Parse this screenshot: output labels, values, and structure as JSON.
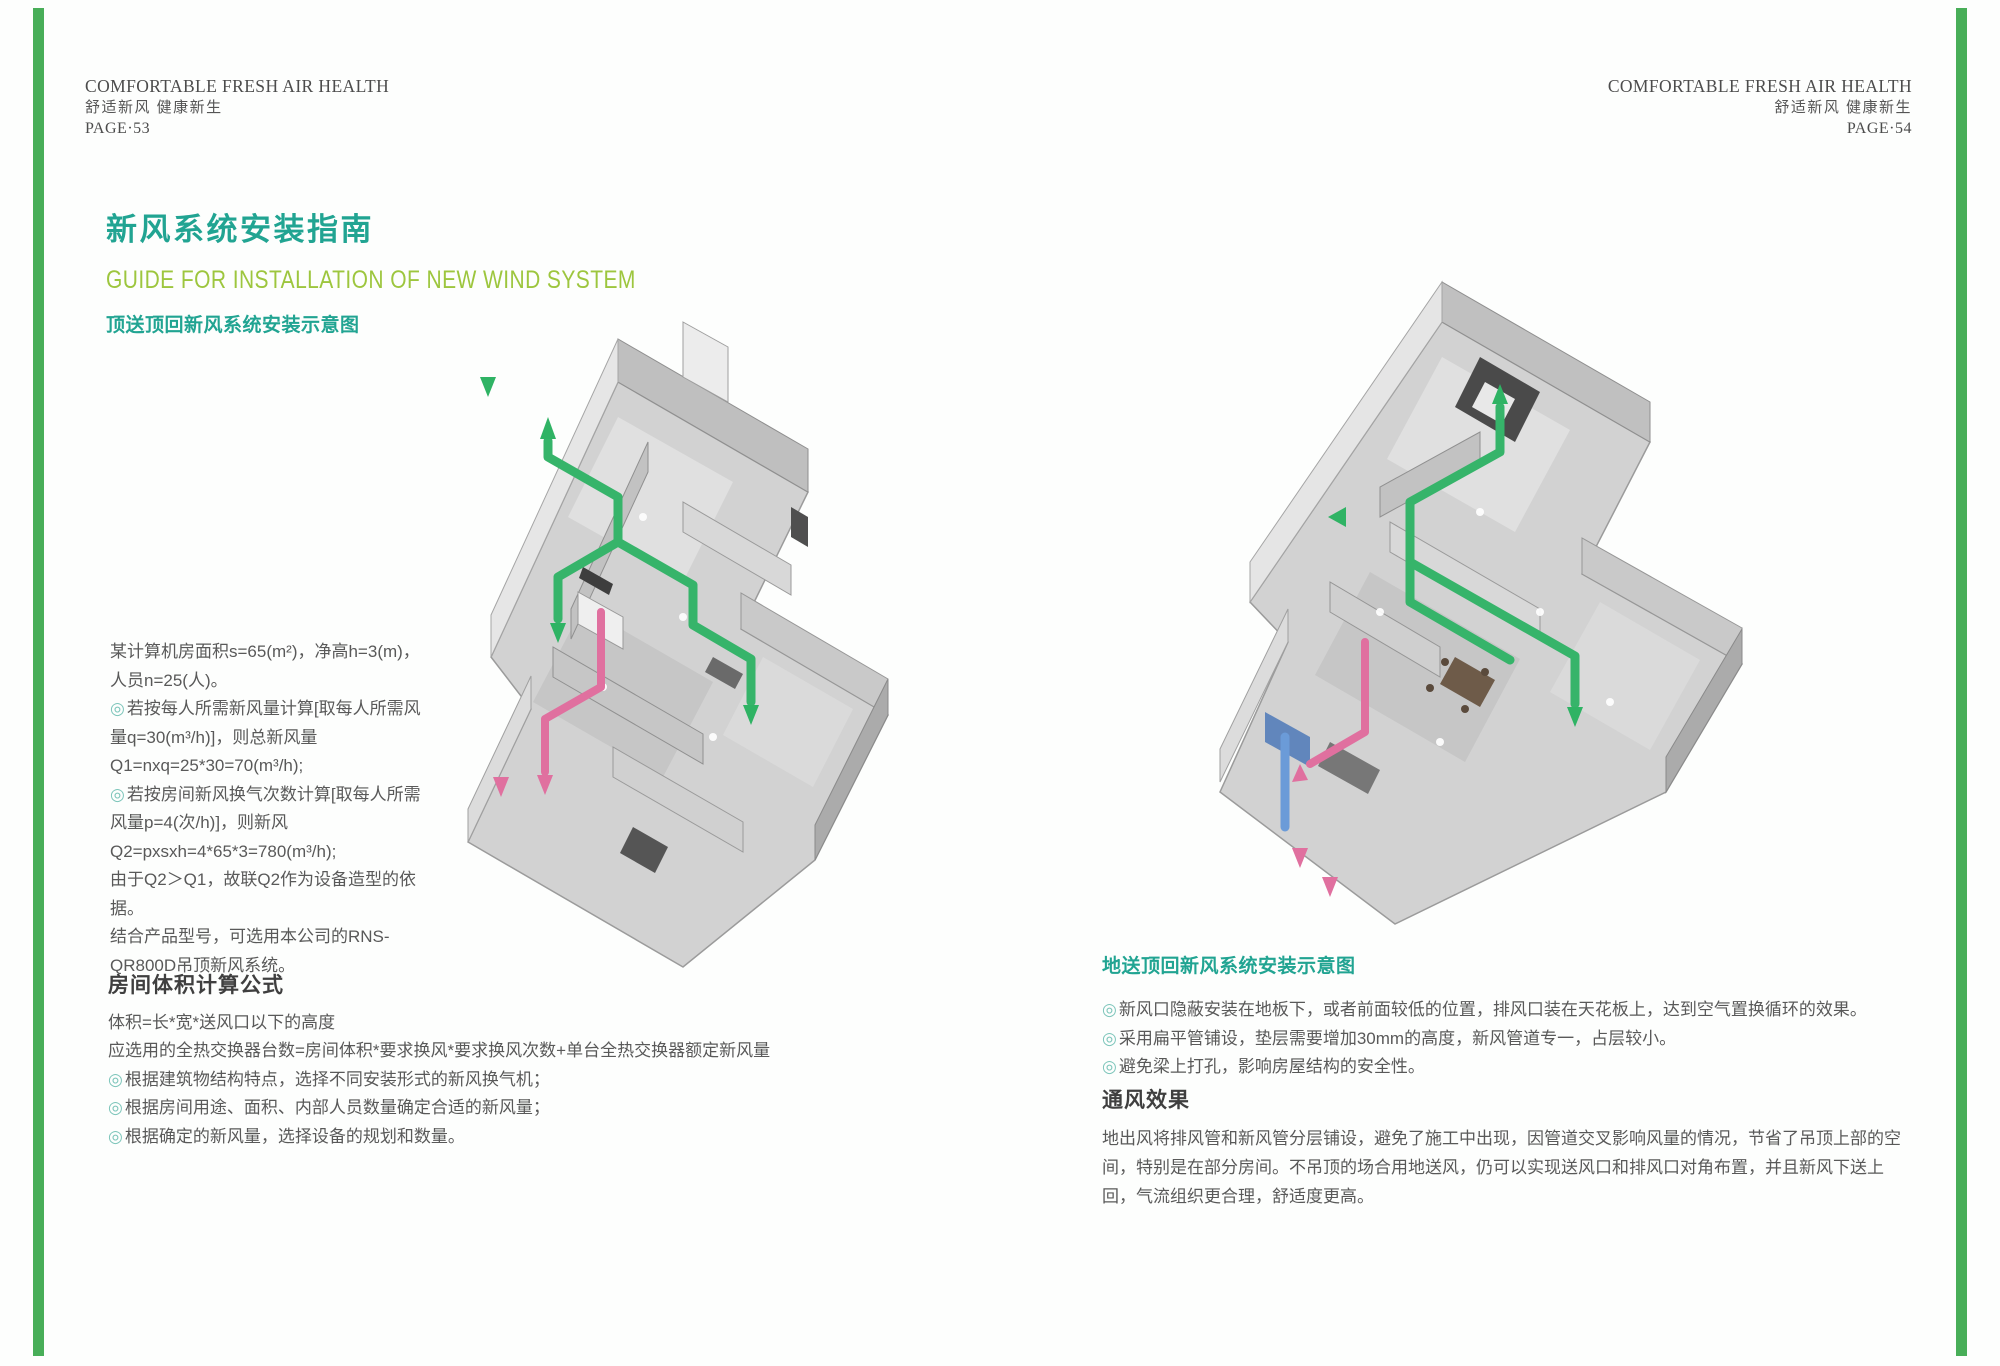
{
  "colors": {
    "accent_teal": "#21a492",
    "accent_green": "#9dc63e",
    "edge_bar_green": "#48ae58",
    "body_text": "#595959",
    "heading_text": "#3f3f3f",
    "header_text": "#4c4c4c",
    "bullet_ring": "#7cc5ba",
    "duct_green": "#36b46a",
    "duct_pink": "#e0709f",
    "duct_blue": "#6b9bd8"
  },
  "bullet_glyph": "◎",
  "left_page": {
    "header": {
      "line1": "COMFORTABLE FRESH AIR HEALTH",
      "line2": "舒适新风  健康新生",
      "page": "PAGE·53"
    },
    "title": "新风系统安装指南",
    "subtitle": "GUIDE FOR INSTALLATION OF NEW WIND SYSTEM",
    "diagram_label": "顶送顶回新风系统安装示意图",
    "calc_text": {
      "p0": "某计算机房面积s=65(m²)，净高h=3(m)，人员n=25(人)。",
      "p1": "若按每人所需新风量计算[取每人所需风量q=30(m³/h)]，则总新风量Q1=nxq=25*30=70(m³/h);",
      "p2": "若按房间新风换气次数计算[取每人所需风量p=4(次/h)]，则新风Q2=pxsxh=4*65*3=780(m³/h);",
      "p3": "由于Q2＞Q1，故联Q2作为设备造型的依据。",
      "p4": "结合产品型号，可选用本公司的RNS-QR800D吊顶新风系统。"
    },
    "volume_section": {
      "heading": "房间体积计算公式",
      "line0": "体积=长*宽*送风口以下的高度",
      "line1": "应选用的全热交换器台数=房间体积*要求换风*要求换风次数+单台全热交换器额定新风量",
      "bullet0": "根据建筑物结构特点，选择不同安装形式的新风换气机；",
      "bullet1": "根据房间用途、面积、内部人员数量确定合适的新风量；",
      "bullet2": "根据确定的新风量，选择设备的规划和数量。"
    }
  },
  "right_page": {
    "header": {
      "line1": "COMFORTABLE FRESH AIR HEALTH",
      "line2": "舒适新风  健康新生",
      "page": "PAGE·54"
    },
    "diagram_label": "地送顶回新风系统安装示意图",
    "bullet0": "新风口隐蔽安装在地板下，或者前面较低的位置，排风口装在天花板上，达到空气置换循环的效果。",
    "bullet1": "采用扁平管铺设，垫层需要增加30mm的高度，新风管道专一，占层较小。",
    "bullet2": "避免梁上打孔，影响房屋结构的安全性。",
    "effect_section": {
      "heading": "通风效果",
      "paragraph": "地出风将排风管和新风管分层铺设，避免了施工中出现，因管道交叉影响风量的情况，节省了吊顶上部的空间，特别是在部分房间。不吊顶的场合用地送风，仍可以实现送风口和排风口对角布置，并且新风下送上回，气流组织更合理，舒适度更高。"
    }
  }
}
